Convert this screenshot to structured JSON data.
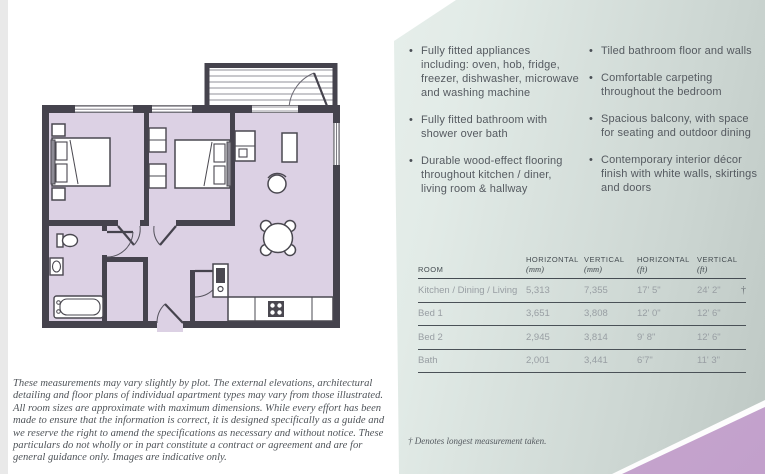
{
  "features": {
    "left": [
      "Fully fitted appliances including: oven, hob, fridge, freezer, dishwasher, microwave and washing machine",
      "Fully fitted bathroom with shower over bath",
      "Durable wood-effect flooring throughout kitchen / diner, living room & hallway"
    ],
    "right": [
      "Tiled bathroom floor and walls",
      "Comfortable carpeting throughout the bedroom",
      "Spacious balcony, with space for seating and outdoor dining",
      "Contemporary interior décor finish with white walls, skirtings and doors"
    ],
    "bullet_glyph": "•"
  },
  "table": {
    "headers": [
      {
        "label": "ROOM",
        "unit": ""
      },
      {
        "label": "HORIZONTAL",
        "unit": "(mm)"
      },
      {
        "label": "VERTICAL",
        "unit": "(mm)"
      },
      {
        "label": "HORIZONTAL",
        "unit": "(ft)"
      },
      {
        "label": "VERTICAL",
        "unit": "(ft)"
      }
    ],
    "rows": [
      {
        "room": "Kitchen / Dining / Living",
        "h_mm": "5,313",
        "v_mm": "7,355",
        "h_ft": "17' 5\"",
        "v_ft": "24' 2\"",
        "dagger": "†"
      },
      {
        "room": "Bed 1",
        "h_mm": "3,651",
        "v_mm": "3,808",
        "h_ft": "12' 0\"",
        "v_ft": "12' 6\"",
        "dagger": ""
      },
      {
        "room": "Bed 2",
        "h_mm": "2,945",
        "v_mm": "3,814",
        "h_ft": "9' 8\"",
        "v_ft": "12' 6\"",
        "dagger": ""
      },
      {
        "room": "Bath",
        "h_mm": "2,001",
        "v_mm": "3,441",
        "h_ft": "6'7\"",
        "v_ft": "11' 3\"",
        "dagger": ""
      }
    ]
  },
  "footnote": "† Denotes longest measurement taken.",
  "disclaimer": "These measurements may vary slightly by plot. The external elevations, architectural detailing and floor plans of individual apartment types may vary from those illustrated. All room sizes are approximate with maximum dimensions. While every effort has been made to ensure that the information is correct, it is designed specifically as a guide and we reserve the right to amend the specifications as necessary and without notice. These particulars do not wholly or in part constitute a contract or agreement and are for general guidance only. Images are indicative only.",
  "colors": {
    "floor": "#dcd1e4",
    "wall": "#45434d",
    "panel_mint_light": "#edf4f0",
    "panel_mint_dark": "#bec8c4",
    "accent_purple": "#c2a0cb"
  }
}
